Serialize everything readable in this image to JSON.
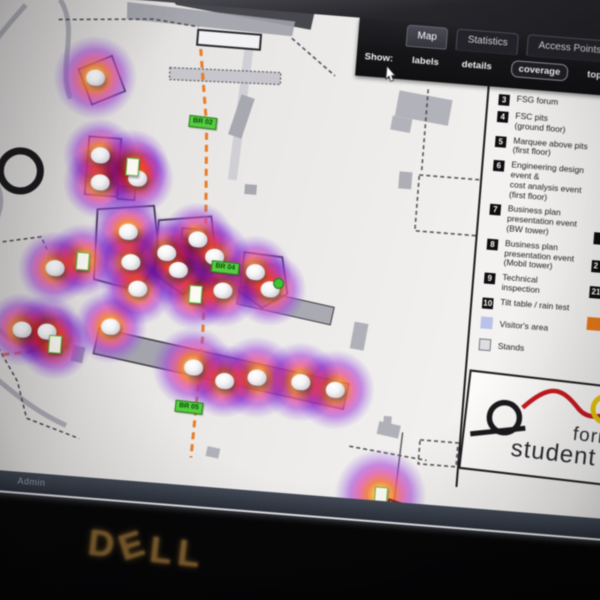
{
  "toolbar": {
    "tabs": [
      {
        "label": "Map",
        "active": true
      },
      {
        "label": "Statistics",
        "active": false
      },
      {
        "label": "Access Points",
        "active": false
      }
    ],
    "show_label": "Show:",
    "options": [
      {
        "label": "labels",
        "selected": false
      },
      {
        "label": "details",
        "selected": false
      },
      {
        "label": "coverage",
        "selected": true
      },
      {
        "label": "topology",
        "selected": false
      },
      {
        "label": "Map",
        "selected": false
      }
    ]
  },
  "legend": {
    "items": [
      {
        "num": "3",
        "label": "FSG forum"
      },
      {
        "num": "4",
        "label": "FSC pits\n(ground floor)"
      },
      {
        "num": "5",
        "label": "Marquee above pits\n(first floor)"
      },
      {
        "num": "6",
        "label": "Engineering design\nevent &\ncost analysis event\n(first floor)"
      },
      {
        "num": "7",
        "label": "Business plan\npresentation event\n(BW tower)"
      },
      {
        "num": "8",
        "label": "Business plan\npresentation event\n(Mobil tower)"
      },
      {
        "num": "9",
        "label": "Technical\ninspection"
      },
      {
        "num": "10",
        "label": "Tilt table / rain test"
      }
    ],
    "area_items": [
      {
        "label": "Visitor's area",
        "swatch_color": "#b9c3ea"
      },
      {
        "label": "Stands",
        "swatch_color": "#dddde2"
      }
    ],
    "overflow_column_nums": [
      "",
      "2",
      "21"
    ],
    "overflow_swatch_color": "#e87a1a"
  },
  "logo": {
    "word1": "formula",
    "word2": "student",
    "badge": "germany"
  },
  "status": {
    "user": "Admin"
  },
  "monitor": {
    "brand_d": "D",
    "brand_e": "E",
    "brand_ll": "LL"
  },
  "colors": {
    "route_orange": "#e8761e",
    "heat_core": "#ffe9a8",
    "heat_mid": "#e054a8",
    "heat_edge": "#9254e0",
    "label_green": "#57cc42",
    "visitor_blue": "#b9c3ea",
    "stands_gray": "#dddde2",
    "legend_orange": "#e87a1a"
  },
  "map_data": {
    "access_point_domes": [
      [
        137,
        81
      ],
      [
        148,
        158
      ],
      [
        150,
        185
      ],
      [
        187,
        178
      ],
      [
        182,
        232
      ],
      [
        187,
        262
      ],
      [
        222,
        250
      ],
      [
        235,
        266
      ],
      [
        196,
        288
      ],
      [
        112,
        274
      ],
      [
        84,
        338
      ],
      [
        109,
        338
      ],
      [
        172,
        328
      ],
      [
        252,
        234
      ],
      [
        270,
        250
      ],
      [
        281,
        283
      ],
      [
        312,
        262
      ],
      [
        328,
        278
      ],
      [
        258,
        362
      ],
      [
        290,
        373
      ],
      [
        322,
        367
      ],
      [
        366,
        368
      ],
      [
        401,
        373
      ]
    ],
    "access_point_rects": [
      [
        181,
        166
      ],
      [
        254,
        288
      ],
      [
        139,
        264
      ],
      [
        118,
        349
      ],
      [
        455,
        474
      ]
    ],
    "blob_default_radius": 37,
    "big_blobs": [
      [
        137,
        81,
        42
      ],
      [
        455,
        474,
        46
      ],
      [
        258,
        362,
        41
      ],
      [
        322,
        367,
        41
      ],
      [
        366,
        368,
        40
      ],
      [
        401,
        373,
        40
      ]
    ],
    "routes": [
      {
        "points": "240,44 252,120 262,259 265,330 264,405 263,452"
      },
      {
        "points": "262,259 300,261 333,269"
      },
      {
        "points": "8,376 70,364 135,351"
      }
    ],
    "route_labels": [
      {
        "text": "BR 02",
        "x": 234,
        "y": 111
      },
      {
        "text": "BR 04",
        "x": 268,
        "y": 254
      },
      {
        "text": "BR 05",
        "x": 243,
        "y": 396
      }
    ],
    "green_dots": [
      [
        331,
        266
      ]
    ]
  }
}
